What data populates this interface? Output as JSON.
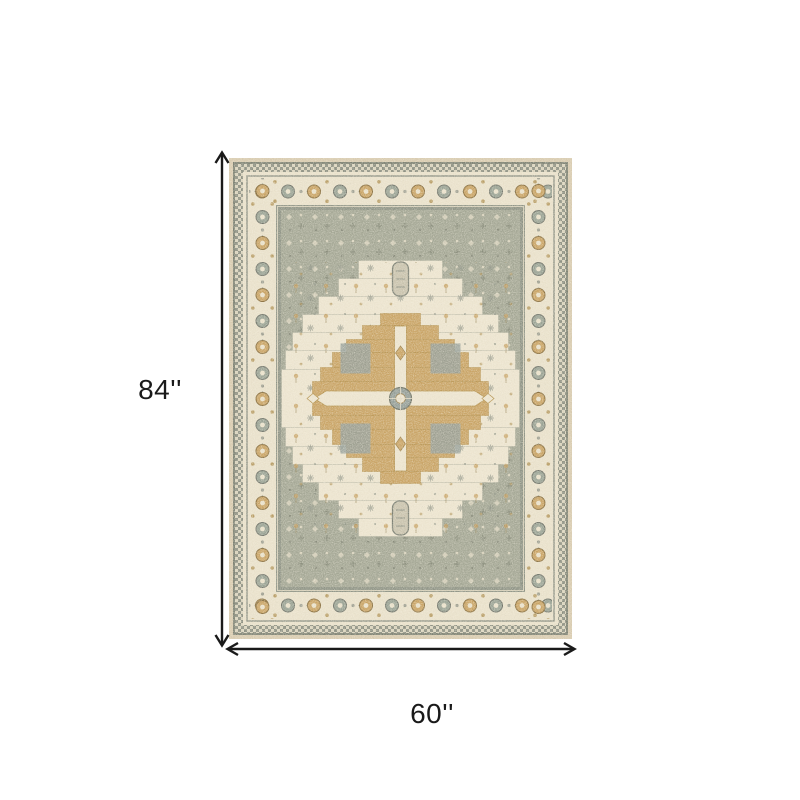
{
  "page": {
    "background_color": "#ffffff"
  },
  "diagram": {
    "type": "product-dimension-diagram",
    "product": "traditional-medallion-area-rug",
    "height_label": "84''",
    "width_label": "60''"
  },
  "palette": {
    "page_bg": "#ffffff",
    "ink": "#1a1a1a",
    "rug_edge_tan": "#d8cbb0",
    "rug_ivory": "#e9e1cb",
    "rug_ivory_light": "#ece4cf",
    "rug_field_sage": "#a4a795",
    "rug_gold": "#c9a466",
    "rug_gold_dark": "#b3924f",
    "rug_gray_green": "#8f9486",
    "rug_gray_blue": "#96a09a",
    "rug_outline_dark": "#6f7365"
  }
}
